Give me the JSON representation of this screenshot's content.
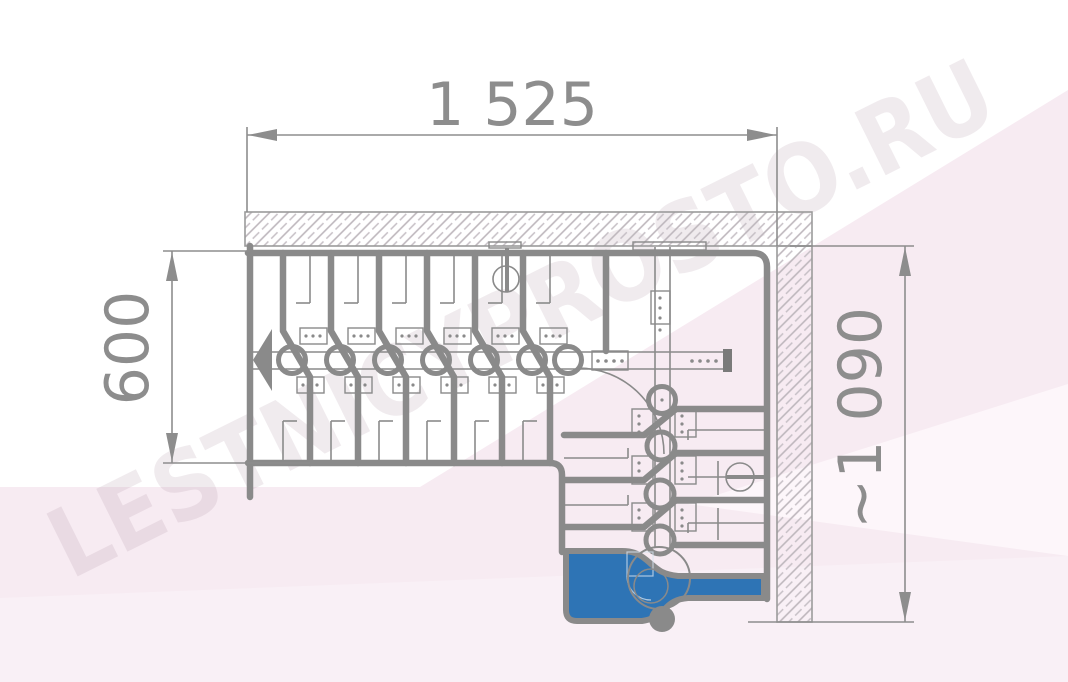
{
  "drawing": {
    "title": "L-shaped modular staircase floor plan",
    "watermark": "LESTNICYPROSTO.RU",
    "dimensions": {
      "top_width_mm": "1 525",
      "left_depth_mm": "600",
      "right_height_mm": "~1 090"
    },
    "colors": {
      "line_gray": "#8a8a8a",
      "dimension_gray": "#8d8d8d",
      "first_step_blue": "#2e74b5",
      "wall_hatch": "#bdb6bc",
      "background_pink": "#f7ebf2"
    }
  }
}
